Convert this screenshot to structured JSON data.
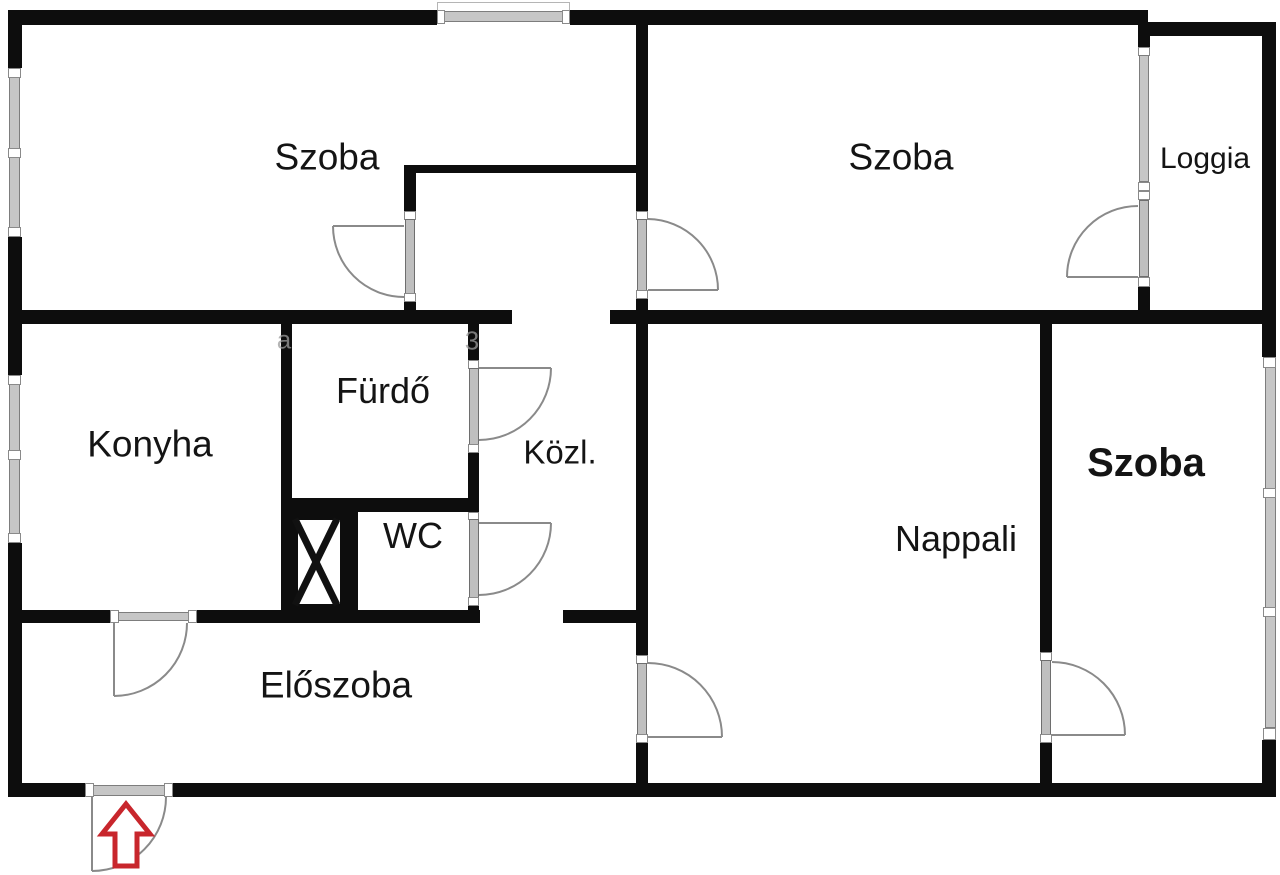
{
  "plan": {
    "type": "apartment-floor-plan",
    "background_color": "#ffffff",
    "wall_color": "#0d0d0d",
    "glazing_color": "#c6c6c6",
    "door_arc_color": "#8a8a8a",
    "entrance_arrow_color": "#c8262c",
    "rooms": [
      {
        "id": "szoba-top-left",
        "label": "Szoba"
      },
      {
        "id": "szoba-top-right",
        "label": "Szoba"
      },
      {
        "id": "loggia",
        "label": "Loggia"
      },
      {
        "id": "konyha",
        "label": "Konyha"
      },
      {
        "id": "furdo",
        "label": "Fürdő"
      },
      {
        "id": "kozl",
        "label": "Közl."
      },
      {
        "id": "wc",
        "label": "WC"
      },
      {
        "id": "eloszoba",
        "label": "Előszoba"
      },
      {
        "id": "nappali",
        "label": "Nappali"
      },
      {
        "id": "szoba-bottom-right",
        "label": "Szoba"
      }
    ],
    "entrance": {
      "symbol": "red-up-arrow",
      "location": "bottom-left-exterior-door"
    },
    "watermarks": [
      {
        "text": "a"
      },
      {
        "text": "3"
      }
    ]
  }
}
